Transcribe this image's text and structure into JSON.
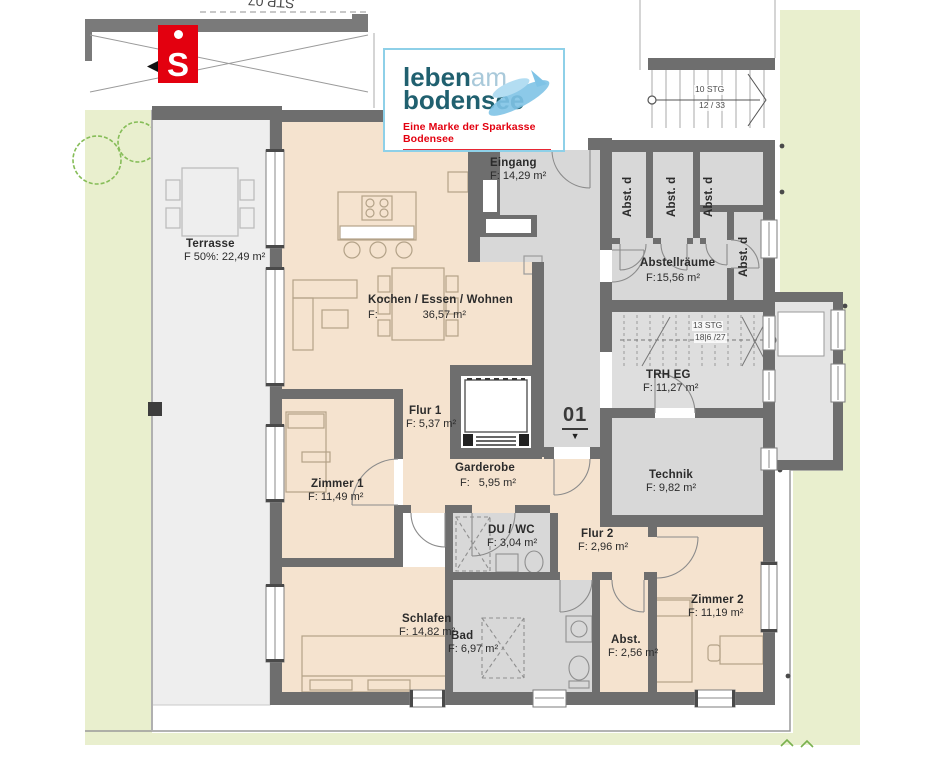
{
  "branding": {
    "sparkasse_icon": "S",
    "logo": {
      "word1_bold": "leben",
      "word1_light": "am",
      "word2": "bodensee",
      "tagline": "Eine Marke der Sparkasse Bodensee"
    },
    "colors": {
      "sparkasse_red": "#e3000f",
      "brand_teal": "#20606f",
      "brand_light_blue": "#a9c9da",
      "card_border": "#8ed0e8"
    }
  },
  "site": {
    "neighbor_parking_label": "STP 07",
    "exterior_stair_line1": "10 STG",
    "exterior_stair_line2": "12 / 33",
    "interior_stair_line1": "13 STG",
    "interior_stair_line2": "18|6 /27"
  },
  "unit": {
    "number": "01",
    "marker": "▼"
  },
  "rooms": {
    "terrasse": {
      "name": "Terrasse",
      "area": "F 50%: 22,49 m²"
    },
    "kochen": {
      "name": "Kochen / Essen / Wohnen",
      "area_label": "F:",
      "area_value": "36,57 m²"
    },
    "eingang": {
      "name": "Eingang",
      "area": "F: 14,29 m²"
    },
    "abstellraeume": {
      "name": "Abstellräume",
      "area_label": "F:",
      "area_value": "15,56 m²"
    },
    "abst_d": {
      "name": "Abst. d"
    },
    "trh": {
      "name": "TRH EG",
      "area": "F: 11,27 m²"
    },
    "technik": {
      "name": "Technik",
      "area": "F: 9,82 m²"
    },
    "flur1": {
      "name": "Flur 1",
      "area": "F: 5,37 m²"
    },
    "garderobe": {
      "name": "Garderobe",
      "area_label": "F:",
      "area_value": "5,95 m²"
    },
    "zimmer1": {
      "name": "Zimmer 1",
      "area": "F: 11,49 m²"
    },
    "duwc": {
      "name": "DU / WC",
      "area": "F: 3,04 m²"
    },
    "flur2": {
      "name": "Flur 2",
      "area": "F: 2,96 m²"
    },
    "schlafen": {
      "name": "Schlafen",
      "area": "F: 14,82 m²"
    },
    "bad": {
      "name": "Bad",
      "area": "F: 6,97 m²"
    },
    "abst": {
      "name": "Abst.",
      "area": "F: 2,56 m²"
    },
    "zimmer2": {
      "name": "Zimmer 2",
      "area": "F: 11,19 m²"
    }
  },
  "palette": {
    "wall": "#6e6e6e",
    "room_living": "#f5e3cf",
    "room_service": "#d8d8d8",
    "terrace": "#eeeeee",
    "lawn": "#e9efce",
    "tree": "#86bd58"
  }
}
